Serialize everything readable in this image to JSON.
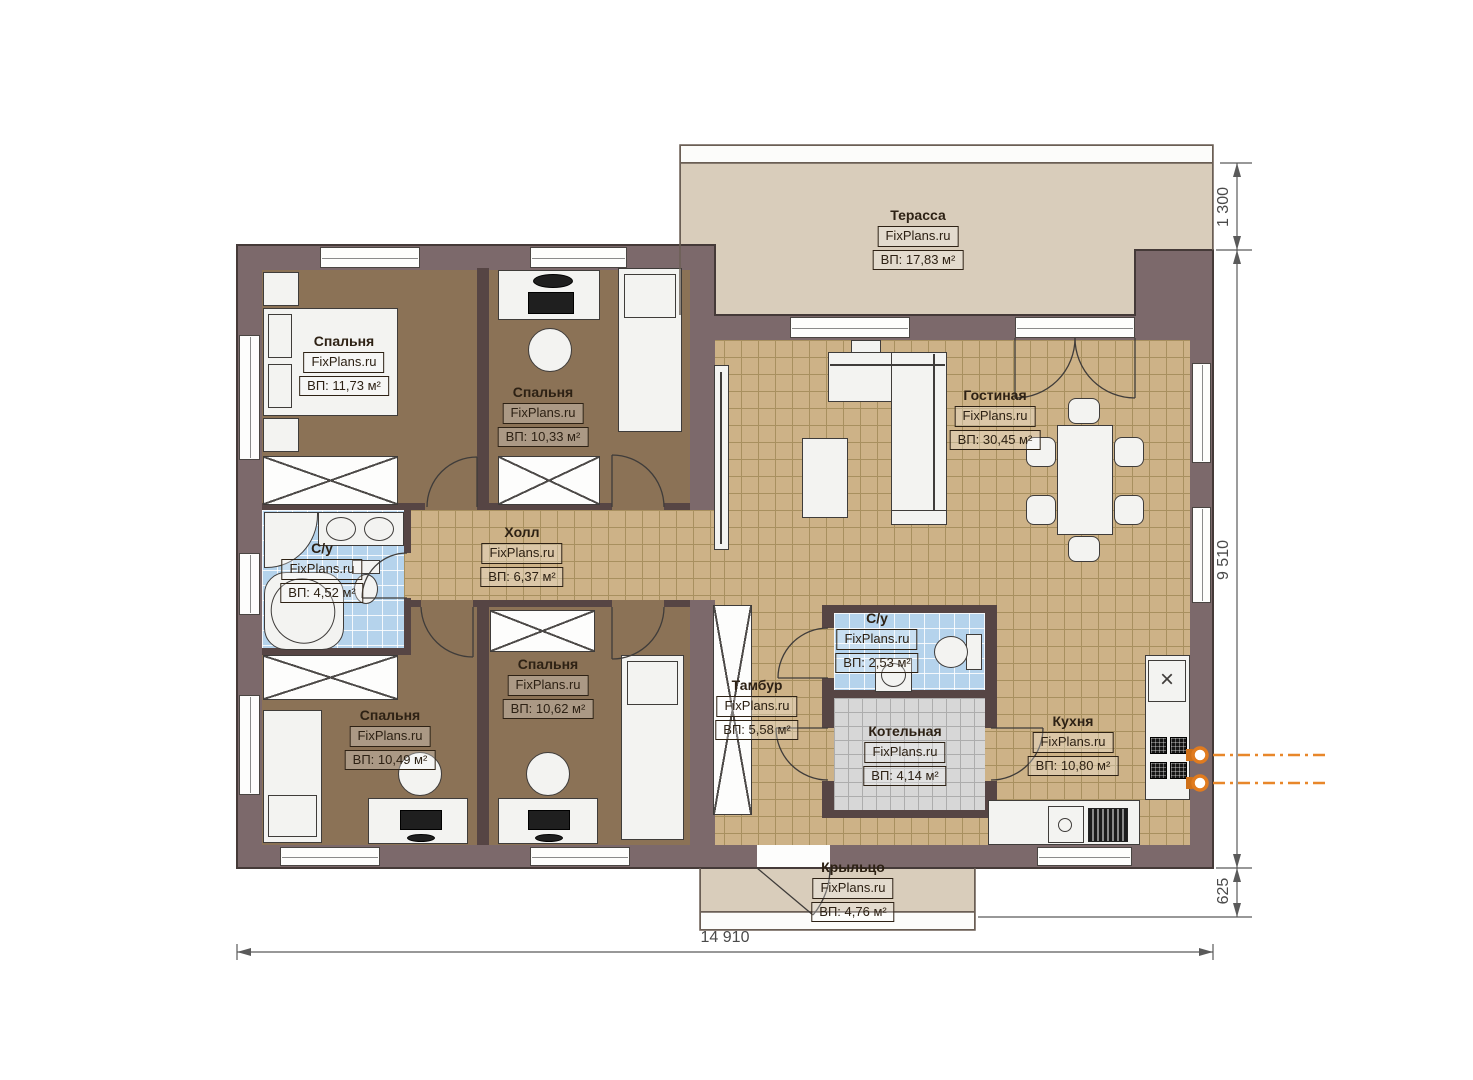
{
  "watermark": "FixPlans.ru",
  "rooms": {
    "terrace": {
      "name": "Терасса",
      "area": "ВП: 17,83 м²"
    },
    "bedroom1": {
      "name": "Спальня",
      "area": "ВП: 11,73 м²"
    },
    "bedroom2": {
      "name": "Спальня",
      "area": "ВП: 10,33 м²"
    },
    "living": {
      "name": "Гостиная",
      "area": "ВП: 30,45 м²"
    },
    "hall": {
      "name": "Холл",
      "area": "ВП: 6,37 м²"
    },
    "bath1": {
      "name": "С/у",
      "area": "ВП: 4,52 м²"
    },
    "bedroom3": {
      "name": "Спальня",
      "area": "ВП: 10,49 м²"
    },
    "bedroom4": {
      "name": "Спальня",
      "area": "ВП: 10,62 м²"
    },
    "tambour": {
      "name": "Тамбур",
      "area": "ВП: 5,58 м²"
    },
    "bath2": {
      "name": "С/у",
      "area": "ВП: 2,53 м²"
    },
    "boiler": {
      "name": "Котельная",
      "area": "ВП: 4,14 м²"
    },
    "kitchen": {
      "name": "Кухня",
      "area": "ВП: 10,80 м²"
    },
    "porch": {
      "name": "Крыльцо",
      "area": "ВП: 4,76 м²"
    }
  },
  "dimensions": {
    "width_total": "14 910",
    "terrace_depth": "1 300",
    "house_depth": "9 510",
    "porch_depth": "625"
  },
  "icons": {
    "sink_cross": "×"
  },
  "colors": {
    "wall": "#7c696b",
    "partition": "#564544",
    "tile_floor": "#cdb287",
    "bedroom_floor": "#8b7256",
    "bath_tile": "#b5d3ec",
    "boiler_tile": "#d7d7d7",
    "terrace_floor": "#d9cdbb",
    "gas_accent": "#e8872a"
  }
}
